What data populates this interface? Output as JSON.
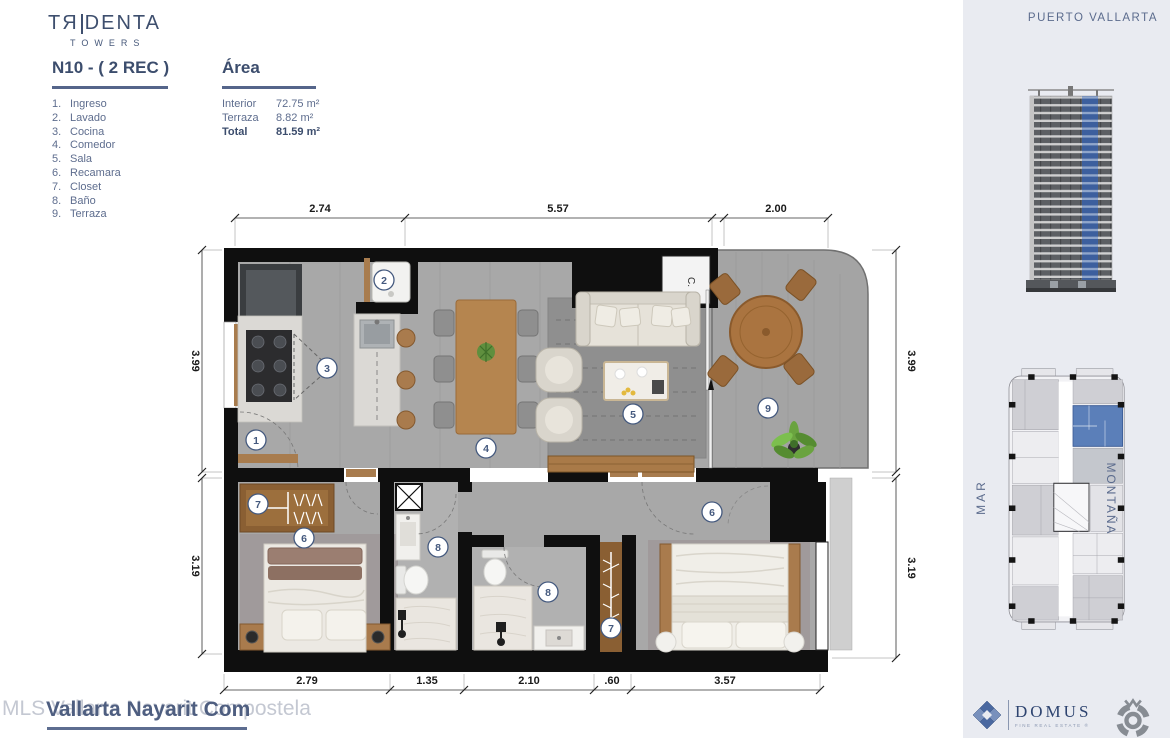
{
  "brand": {
    "name_left": "TЯ",
    "name_right": "DENTA",
    "sub": "TOWERS"
  },
  "header": {
    "unit": "N10 - ( 2 REC )",
    "area_title": "Área"
  },
  "legend": [
    {
      "num": "1.",
      "label": "Ingreso"
    },
    {
      "num": "2.",
      "label": "Lavado"
    },
    {
      "num": "3.",
      "label": "Cocina"
    },
    {
      "num": "4.",
      "label": "Comedor"
    },
    {
      "num": "5.",
      "label": "Sala"
    },
    {
      "num": "6.",
      "label": "Recamara"
    },
    {
      "num": "7.",
      "label": "Closet"
    },
    {
      "num": "8.",
      "label": "Baño"
    },
    {
      "num": "9.",
      "label": "Terraza"
    }
  ],
  "area_table": [
    {
      "label": "Interior",
      "value": "72.75 m²"
    },
    {
      "label": "Terraza",
      "value": "8.82 m²"
    },
    {
      "label": "Total",
      "value": "81.59 m²"
    }
  ],
  "floorplan": {
    "dims_top": [
      "2.74",
      "5.57",
      "2.00"
    ],
    "dims_left": [
      "3.99",
      "3.19"
    ],
    "dims_right": [
      "3.99",
      "3.19"
    ],
    "dims_bottom": [
      "2.79",
      "1.35",
      "2.10",
      ".60",
      "3.57"
    ],
    "markers": [
      "1",
      "2",
      "3",
      "4",
      "5",
      "6",
      "7",
      "8",
      "9"
    ],
    "closet_label": "C."
  },
  "sidebar": {
    "location": "PUERTO VALLARTA",
    "keyplan_left": "MAR",
    "keyplan_right": "MONTAÑA"
  },
  "watermark": {
    "light": "MLS Vallarta Nayarit Compostela",
    "dark": "Vallarta Nayarit Com"
  },
  "footer": {
    "domus": "DOMUS",
    "domus_sub": "FINE REAL ESTATE",
    "registered": "®"
  },
  "colors": {
    "accent_blue": "#5b7fb9",
    "brand_navy": "#3e4f6e"
  }
}
